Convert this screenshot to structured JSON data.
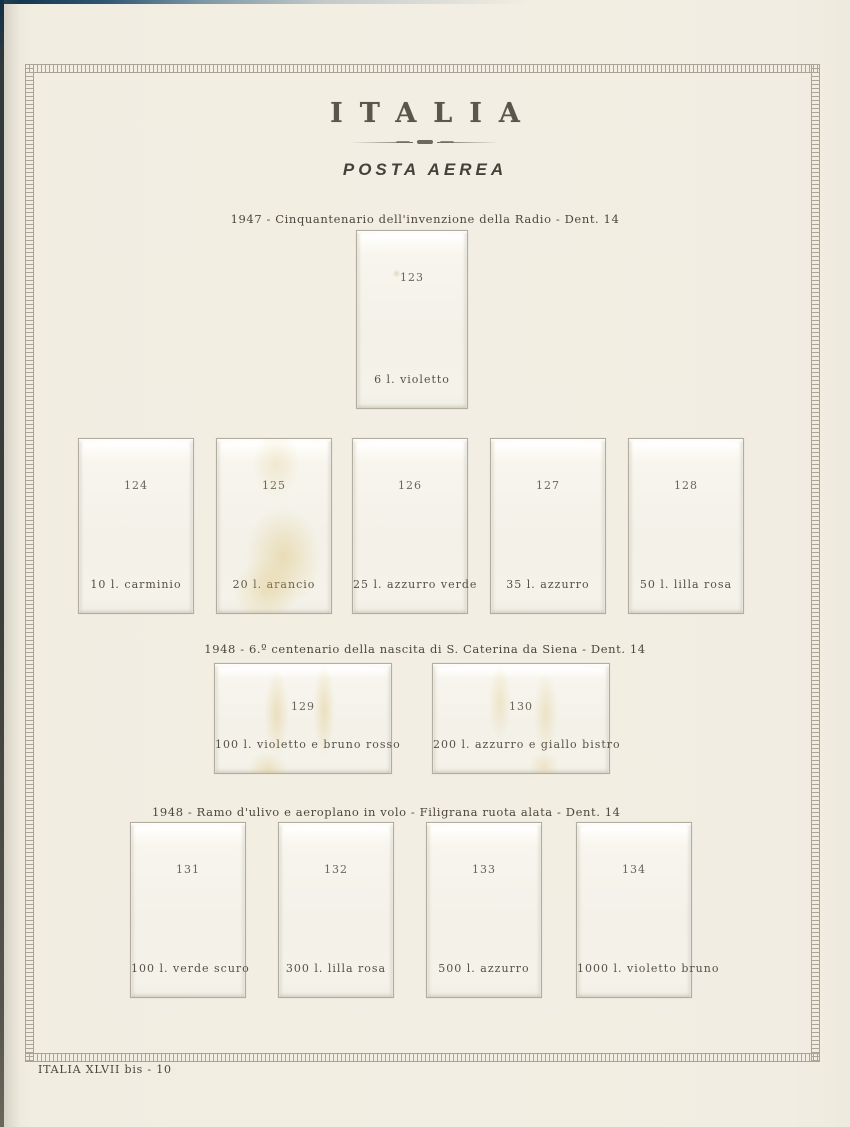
{
  "page": {
    "title": "ITALIA",
    "subtitle": "POSTA AEREA",
    "footer": "ITALIA XLVII bis - 10"
  },
  "sections": [
    {
      "heading": "1947 - Cinquantenario dell'invenzione della Radio - Dent. 14"
    },
    {
      "heading": "1948 - 6.º centenario della nascita di S. Caterina da Siena - Dent. 14"
    },
    {
      "heading": "1948 - Ramo d'ulivo e aeroplano in volo - Filigrana ruota alata - Dent. 14"
    }
  ],
  "stamps": [
    {
      "number": "123",
      "caption": "6 l. violetto"
    },
    {
      "number": "124",
      "caption": "10 l. carminio"
    },
    {
      "number": "125",
      "caption": "20 l. arancio"
    },
    {
      "number": "126",
      "caption": "25 l. azzurro verde"
    },
    {
      "number": "127",
      "caption": "35 l. azzurro"
    },
    {
      "number": "128",
      "caption": "50 l. lilla rosa"
    },
    {
      "number": "129",
      "caption": "100 l. violetto e bruno rosso"
    },
    {
      "number": "130",
      "caption": "200 l. azzurro e giallo bistro"
    },
    {
      "number": "131",
      "caption": "100 l. verde scuro"
    },
    {
      "number": "132",
      "caption": "300 l. lilla rosa"
    },
    {
      "number": "133",
      "caption": "500 l. azzurro"
    },
    {
      "number": "134",
      "caption": "1000 l. violetto bruno"
    }
  ],
  "colors": {
    "paper": "#f2eee3",
    "mount_face": "#f4f2e9",
    "mount_border": "#b2ad9f",
    "ink": "#565147",
    "frame_ornament": "#a9a395",
    "stain": "#d8ba64",
    "scan_edge_blue": "#10314a"
  }
}
